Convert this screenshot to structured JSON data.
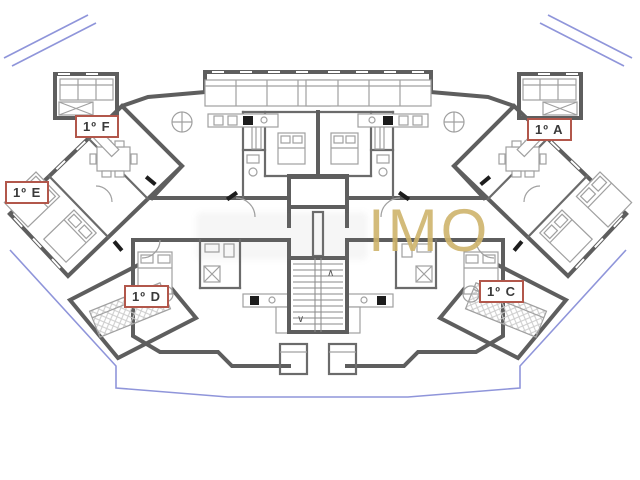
{
  "plan": {
    "type": "residential-floor-plan",
    "units": [
      {
        "id": "F",
        "text": "1º F"
      },
      {
        "id": "E",
        "text": "1º E"
      },
      {
        "id": "A",
        "text": "1º A"
      },
      {
        "id": "D",
        "text": "1º D"
      },
      {
        "id": "C",
        "text": "1º C"
      }
    ],
    "stair_arrows": {
      "up": "∧",
      "down": "∨"
    },
    "watermark": {
      "text": "IMO",
      "color": "#cfb46c"
    },
    "colors": {
      "wall": "#5e5e5e",
      "partition": "#6b6b6b",
      "furniture": "#a0a0a0",
      "balcony_line": "#8f95da",
      "label_border": "#b2574b",
      "label_text": "#3a3a3a",
      "background": "#ffffff"
    }
  }
}
